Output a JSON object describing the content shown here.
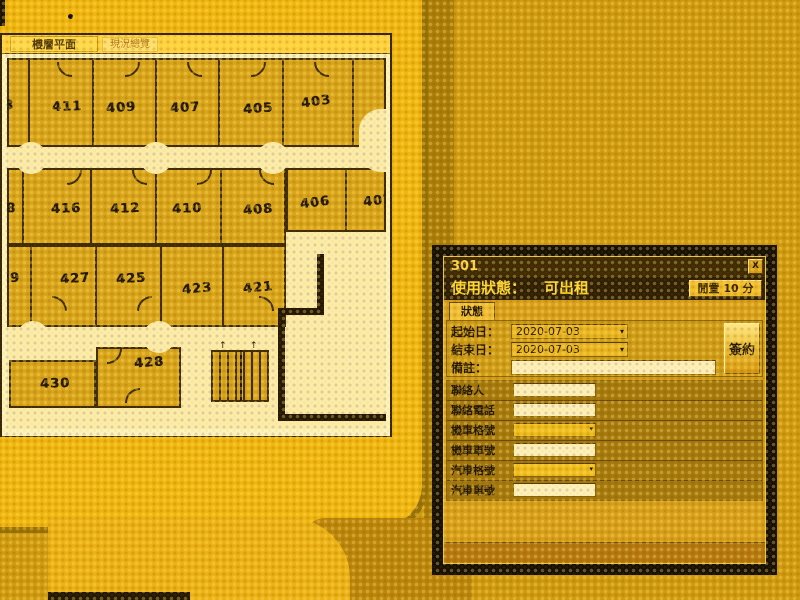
{
  "app": {
    "tabs": [
      {
        "label": "樓層平面"
      },
      {
        "label": "現況總覽"
      }
    ]
  },
  "floorplan": {
    "colors": {
      "room": "#d8a41a",
      "corridor": "#fbecae",
      "wall": "#3f2c04",
      "text": "#241803"
    },
    "blocks": [
      {
        "x": 0,
        "y": 0,
        "w": 379,
        "h": 89
      },
      {
        "x": 0,
        "y": 110,
        "w": 279,
        "h": 77
      },
      {
        "x": 279,
        "y": 110,
        "w": 100,
        "h": 64
      },
      {
        "x": 0,
        "y": 187,
        "w": 279,
        "h": 82
      },
      {
        "x": 2,
        "y": 302,
        "w": 87,
        "h": 48
      },
      {
        "x": 89,
        "y": 289,
        "w": 85,
        "h": 61
      }
    ],
    "vwalls": [
      {
        "x": 22,
        "y1": 0,
        "y2": 89
      },
      {
        "x": 86,
        "y1": 0,
        "y2": 89
      },
      {
        "x": 149,
        "y1": 0,
        "y2": 89
      },
      {
        "x": 212,
        "y1": 0,
        "y2": 89
      },
      {
        "x": 276,
        "y1": 0,
        "y2": 89
      },
      {
        "x": 346,
        "y1": 0,
        "y2": 89
      },
      {
        "x": 16,
        "y1": 110,
        "y2": 187
      },
      {
        "x": 84,
        "y1": 110,
        "y2": 187
      },
      {
        "x": 149,
        "y1": 110,
        "y2": 187
      },
      {
        "x": 214,
        "y1": 110,
        "y2": 187
      },
      {
        "x": 339,
        "y1": 110,
        "y2": 174
      },
      {
        "x": 24,
        "y1": 187,
        "y2": 269
      },
      {
        "x": 89,
        "y1": 187,
        "y2": 269
      },
      {
        "x": 154,
        "y1": 187,
        "y2": 269
      },
      {
        "x": 216,
        "y1": 187,
        "y2": 269
      }
    ],
    "thick": [
      {
        "x": 310,
        "y": 196,
        "w": 7,
        "h": 60
      },
      {
        "x": 271,
        "y": 250,
        "w": 46,
        "h": 7
      },
      {
        "x": 271,
        "y": 250,
        "w": 7,
        "h": 112
      },
      {
        "x": 271,
        "y": 356,
        "w": 108,
        "h": 7
      }
    ],
    "bumps": [
      {
        "cx": 24,
        "cy": 100
      },
      {
        "cx": 149,
        "cy": 100
      },
      {
        "cx": 266,
        "cy": 100
      },
      {
        "cx": 26,
        "cy": 279
      },
      {
        "cx": 152,
        "cy": 279
      }
    ],
    "bump_r": 16,
    "corridor_notch": {
      "x": 352,
      "y": 51,
      "w": 27,
      "h": 63
    },
    "arcs": [
      {
        "x": 50,
        "y": 4,
        "c": "bl"
      },
      {
        "x": 118,
        "y": 4,
        "c": "br"
      },
      {
        "x": 180,
        "y": 4,
        "c": "bl"
      },
      {
        "x": 244,
        "y": 4,
        "c": "br"
      },
      {
        "x": 307,
        "y": 4,
        "c": "bl"
      },
      {
        "x": 60,
        "y": 112,
        "c": "br"
      },
      {
        "x": 125,
        "y": 112,
        "c": "bl"
      },
      {
        "x": 190,
        "y": 112,
        "c": "br"
      },
      {
        "x": 252,
        "y": 112,
        "c": "bl"
      },
      {
        "x": 45,
        "y": 238,
        "c": "tr"
      },
      {
        "x": 130,
        "y": 238,
        "c": "tl"
      },
      {
        "x": 252,
        "y": 238,
        "c": "tr"
      },
      {
        "x": 100,
        "y": 291,
        "c": "br"
      },
      {
        "x": 118,
        "y": 330,
        "c": "tl"
      }
    ],
    "arc_r": 15,
    "stairs": {
      "x": 204,
      "y": 292,
      "w": 58,
      "h": 52,
      "split": 29,
      "arrow": "↑"
    },
    "rooms": [
      {
        "label": "413",
        "x": -8,
        "y": 48,
        "rot": 0
      },
      {
        "label": "411",
        "x": 60,
        "y": 49,
        "rot": -2
      },
      {
        "label": "409",
        "x": 114,
        "y": 50,
        "rot": -4
      },
      {
        "label": "407",
        "x": 178,
        "y": 50,
        "rot": -3
      },
      {
        "label": "405",
        "x": 251,
        "y": 51,
        "rot": -4
      },
      {
        "label": "403",
        "x": 309,
        "y": 44,
        "rot": -8
      },
      {
        "label": "418",
        "x": -6,
        "y": 151,
        "rot": 0
      },
      {
        "label": "416",
        "x": 59,
        "y": 151,
        "rot": -2
      },
      {
        "label": "412",
        "x": 118,
        "y": 151,
        "rot": -3
      },
      {
        "label": "410",
        "x": 180,
        "y": 151,
        "rot": -3
      },
      {
        "label": "408",
        "x": 251,
        "y": 152,
        "rot": -4
      },
      {
        "label": "406",
        "x": 308,
        "y": 145,
        "rot": -7
      },
      {
        "label": "402",
        "x": 371,
        "y": 143,
        "rot": -7
      },
      {
        "label": "429",
        "x": -2,
        "y": 221,
        "rot": -4
      },
      {
        "label": "427",
        "x": 68,
        "y": 221,
        "rot": -4
      },
      {
        "label": "425",
        "x": 124,
        "y": 221,
        "rot": -4
      },
      {
        "label": "423",
        "x": 190,
        "y": 231,
        "rot": -5
      },
      {
        "label": "421",
        "x": 251,
        "y": 230,
        "rot": -5
      },
      {
        "label": "428",
        "x": 142,
        "y": 305,
        "rot": -4
      },
      {
        "label": "430",
        "x": 48,
        "y": 326,
        "rot": -2
      }
    ]
  },
  "dialog": {
    "title": "301",
    "close": "X",
    "status_label": "使用狀態：",
    "status_value": "可出租",
    "timer_button": "閒置 10 分",
    "tab": "狀態",
    "rows_top": [
      {
        "label": "起始日：",
        "value": "2020-07-03",
        "kind": "combo"
      },
      {
        "label": "結束日：",
        "value": "2020-07-03",
        "kind": "combo"
      },
      {
        "label": "備註：",
        "value": "",
        "kind": "input"
      }
    ],
    "sign_button": "簽約",
    "rows_form": [
      {
        "label": "聯絡人",
        "value": "",
        "kind": "input"
      },
      {
        "label": "聯絡電話",
        "value": "",
        "kind": "input"
      },
      {
        "label": "機車格號",
        "value": "",
        "kind": "combo"
      },
      {
        "label": "機車車號",
        "value": "",
        "kind": "input"
      },
      {
        "label": "汽車格號",
        "value": "",
        "kind": "combo"
      },
      {
        "label": "汽車車號",
        "value": "",
        "kind": "input"
      }
    ]
  }
}
